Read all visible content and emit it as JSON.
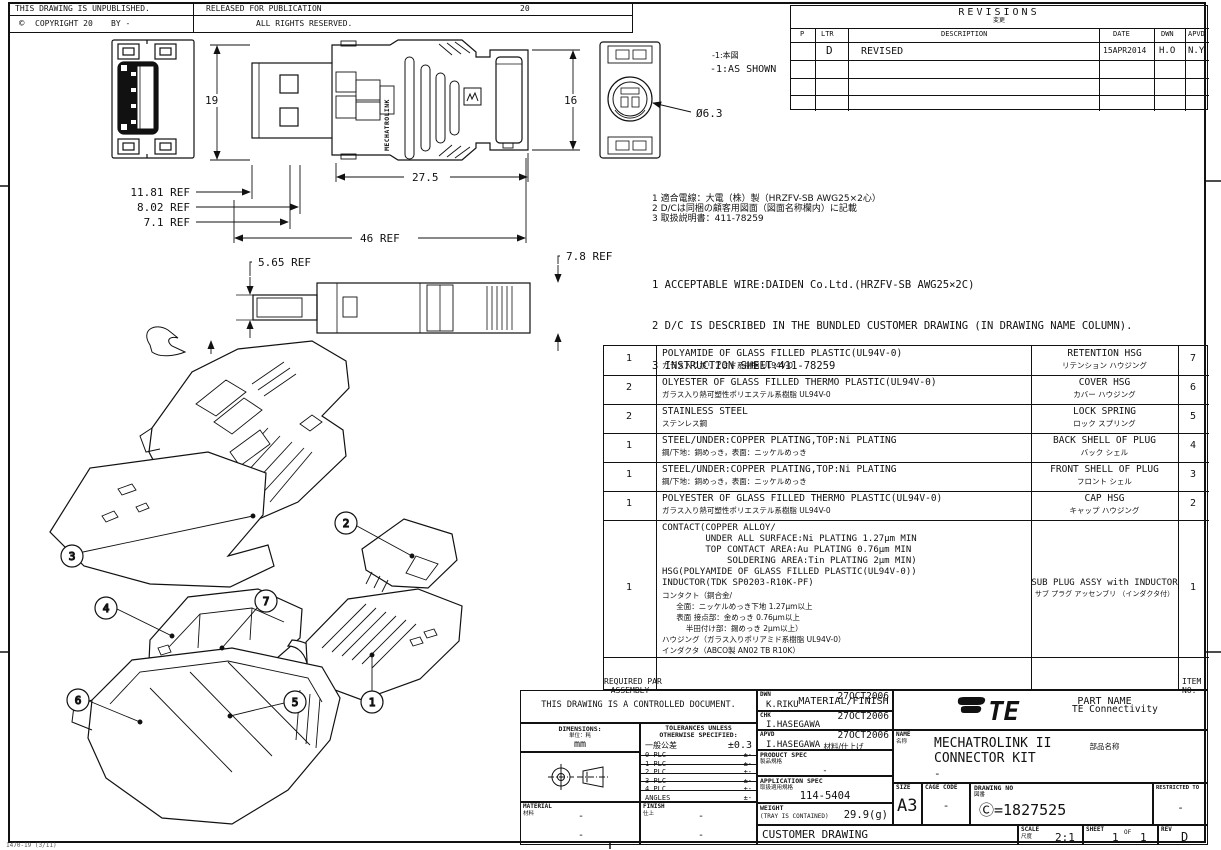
{
  "header": {
    "unpublished": "THIS DRAWING IS UNPUBLISHED.",
    "released": "RELEASED FOR PUBLICATION",
    "released_year": "20",
    "copyright_symbol": "©",
    "copyright_line": "COPYRIGHT 20",
    "by_line": "BY -",
    "rights": "ALL RIGHTS RESERVED."
  },
  "revisions": {
    "title": "REVISIONS",
    "title_jp": "変更",
    "col_p": "P",
    "col_ltr": "LTR",
    "col_desc": "DESCRIPTION",
    "col_date": "DATE",
    "col_dwn": "DWN",
    "col_apvd": "APVD",
    "rows": [
      {
        "p": "",
        "ltr": "D",
        "description": "REVISED",
        "date": "15APR2014",
        "dwn": "H.O",
        "apvd": "N.Y"
      }
    ]
  },
  "notes_jp": {
    "l1": "1 適合電線：大電（株）製（HRZFV-SB AWG25×2心）",
    "l2": "2 D/Cは同梱の顧客用図面（図面名称欄内）に記載",
    "l3": "3 取扱説明書：411-78259"
  },
  "notes_en": {
    "l1": "1 ACCEPTABLE WIRE:DAIDEN Co.Ltd.(HRZFV-SB AWG25×2C)",
    "l2": "2 D/C IS DESCRIBED IN THE BUNDLED CUSTOMER DRAWING (IN DRAWING NAME COLUMN).",
    "l3": "3 INSTRUCTION SHEET:411-78259"
  },
  "dims": {
    "h19": "19",
    "h16": "16",
    "w275": "27.5",
    "ref1": "11.81 REF",
    "ref2": "8.02 REF",
    "ref3": "7.1 REF",
    "w46": "46 REF",
    "ref565": "5.65 REF",
    "ref78": "7.8 REF",
    "dia": "Ø6.3",
    "view_note_jp": "-1:本図",
    "view_note_en": "-1:AS SHOWN"
  },
  "views": {
    "brand_vertical": "MECHATROLINK"
  },
  "exploded": {
    "balloons": {
      "b1": "1",
      "b2": "2",
      "b3": "3",
      "b4": "4",
      "b5": "5",
      "b6": "6",
      "b7": "7"
    }
  },
  "bom": {
    "header": {
      "qty_line1": "REQUIRED PAR",
      "qty_line2": "ASSEMBLY",
      "material": "MATERIAL/FINISH",
      "material_jp": "材料/仕上げ",
      "part": "PART NAME",
      "part_jp": "部品名称",
      "item_line1": "ITEM",
      "item_line2": "NO."
    },
    "rows": [
      {
        "qty": "1",
        "material_en": "POLYAMIDE OF GLASS FILLED PLASTIC(UL94V-0)",
        "material_jp": "ガラス入りポリアミド系樹脂 UL94V-0",
        "name_en": "RETENTION HSG",
        "name_jp": "リテンション ハウジング",
        "item": "7"
      },
      {
        "qty": "2",
        "material_en": "OLYESTER OF GLASS FILLED THERMO PLASTIC(UL94V-0)",
        "material_jp": "ガラス入り熱可塑性ポリエステル系樹脂 UL94V-0",
        "name_en": "COVER HSG",
        "name_jp": "カバー ハウジング",
        "item": "6"
      },
      {
        "qty": "2",
        "material_en": "STAINLESS STEEL",
        "material_jp": "ステンレス鋼",
        "name_en": "LOCK SPRING",
        "name_jp": "ロック スプリング",
        "item": "5"
      },
      {
        "qty": "1",
        "material_en": "STEEL/UNDER:COPPER PLATING,TOP:Ni PLATING",
        "material_jp": "鋼/下地：銅めっき，表面：ニッケルめっき",
        "name_en": "BACK SHELL OF PLUG",
        "name_jp": "バック シェル",
        "item": "4"
      },
      {
        "qty": "1",
        "material_en": "STEEL/UNDER:COPPER PLATING,TOP:Ni PLATING",
        "material_jp": "鋼/下地：銅めっき，表面：ニッケルめっき",
        "name_en": "FRONT SHELL OF PLUG",
        "name_jp": "フロント シェル",
        "item": "3"
      },
      {
        "qty": "1",
        "material_en": "POLYESTER OF GLASS FILLED THERMO PLASTIC(UL94V-0)",
        "material_jp": "ガラス入り熱可塑性ポリエステル系樹脂 UL94V-0",
        "name_en": "CAP HSG",
        "name_jp": "キャップ ハウジング",
        "item": "2"
      },
      {
        "qty": "1",
        "material_en": "CONTACT(COPPER ALLOY/\n        UNDER ALL SURFACE:Ni PLATING 1.27µm MIN\n        TOP CONTACT AREA:Au PLATING 0.76µm MIN\n            SOLDERING AREA:Tin PLATING 2µm MIN)\nHSG(POLYAMIDE OF GLASS FILLED PLASTIC(UL94V-0))\nINDUCTOR(TDK SP0203-R10K-PF)",
        "material_jp": "コンタクト（銅合金/\n      全面：ニッケルめっき下地 1.27µm以上\n      表面 接点部：金めっき 0.76µm以上\n          半田付け部：錫めっき 2µm以上）\nハウジング（ガラス入りポリアミド系樹脂 UL94V-0）\nインダクタ（ABCO製 AN02 TB R10K）",
        "name_en": "SUB PLUG ASSY with INDUCTOR",
        "name_jp": "サブ プラグ アッセンブリ （インダクタ付）",
        "item": "1"
      }
    ]
  },
  "title_block": {
    "controlled": "THIS DRAWING IS A CONTROLLED DOCUMENT.",
    "dimensions_label": "DIMENSIONS:",
    "dimensions_jp": "単位：粍",
    "dimensions_unit": "mm",
    "tol_title1": "TOLERANCES UNLESS",
    "tol_title2": "OTHERWISE SPECIFIED:",
    "tol_rows": [
      {
        "label": "一般公差",
        "value": "±0.3"
      },
      {
        "label": "0 PLC",
        "value": "±-"
      },
      {
        "label": "1 PLC",
        "value": "±-"
      },
      {
        "label": "2 PLC",
        "value": "±-"
      },
      {
        "label": "3 PLC",
        "value": "±-"
      },
      {
        "label": "4 PLC",
        "value": "±-"
      },
      {
        "label": "ANGLES",
        "value": "±-"
      }
    ],
    "material_label": "MATERIAL",
    "material_jp": "材料",
    "material_value": "-",
    "material_value2": "-",
    "finish_label": "FINISH",
    "finish_jp": "仕上",
    "finish_value": "-",
    "finish_value2": "-",
    "dwn_label": "DWN",
    "dwn_name": "K.RIKU",
    "dwn_date": "27OCT2006",
    "chk_label": "CHK",
    "chk_name": "I.HASEGAWA",
    "chk_date": "27OCT2006",
    "apvd_label": "APVD",
    "apvd_name": "I.HASEGAWA",
    "apvd_date": "27OCT2006",
    "product_spec_label": "PRODUCT SPEC",
    "product_spec_jp": "製品規格",
    "product_spec_value": "-",
    "app_spec_label": "APPLICATION SPEC",
    "app_spec_jp": "取扱適用規格",
    "app_spec_value": "114-5404",
    "weight_label": "WEIGHT",
    "weight_sub": "(TRAY IS CONTAINED)",
    "weight_value": "29.9(g)",
    "customer_drawing": "CUSTOMER DRAWING",
    "logo_text": "TE",
    "brand": "TE Connectivity",
    "name_label": "NAME",
    "name_jp": "名称",
    "name_line1": "MECHATROLINK II",
    "name_line2": "CONNECTOR KIT",
    "name_line3": "-",
    "size_label": "SIZE",
    "size_value": "A3",
    "cage_label": "CAGE CODE",
    "cage_value": "-",
    "dwg_label": "DRAWING NO",
    "dwg_jp": "図番",
    "dwg_value": "Ⓒ=1827525",
    "restricted_label": "RESTRICTED TO",
    "restricted_value": "-",
    "scale_label": "SCALE",
    "scale_jp": "尺度",
    "scale_value": "2:1",
    "sheet_label": "SHEET",
    "sheet_value": "1",
    "sheet_of": "OF",
    "sheet_total": "1",
    "rev_label": "REV",
    "rev_value": "D"
  },
  "footer_code": "1470-19 (3/11)"
}
